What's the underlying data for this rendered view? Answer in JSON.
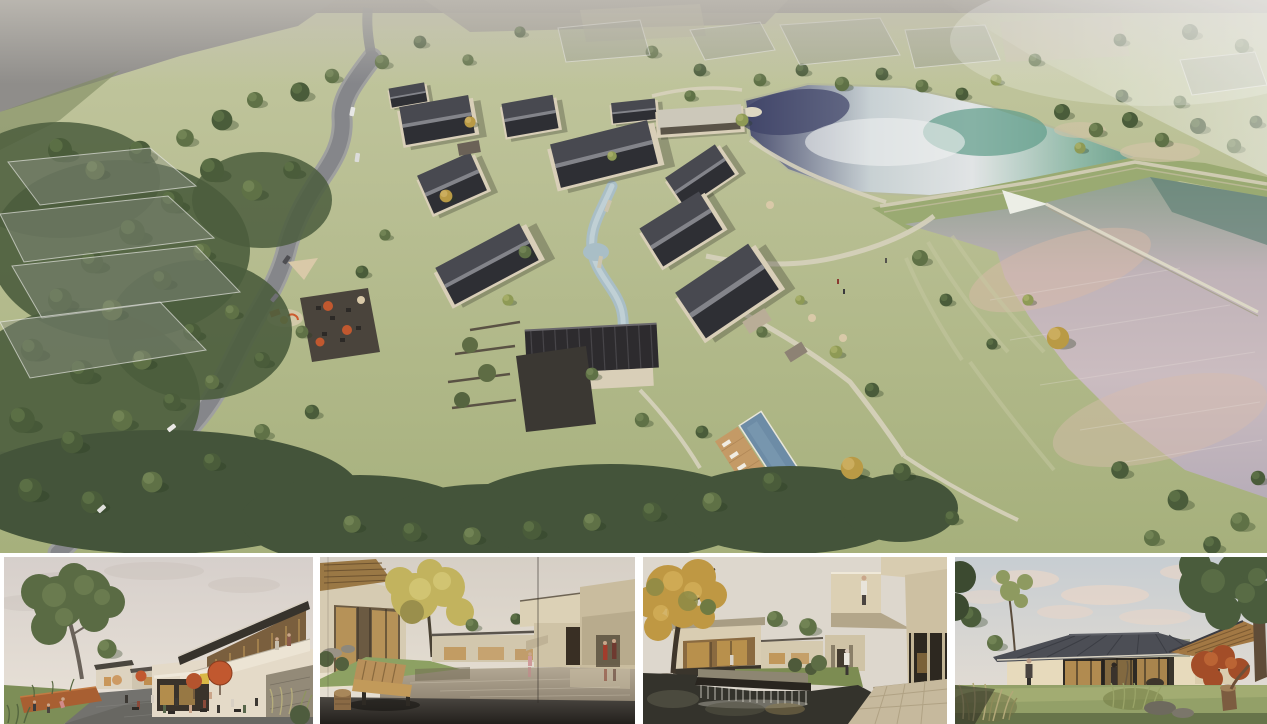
{
  "page": {
    "title": "architectural-rendering-board",
    "description": "Presentation board with one large aerial rendering and four eye-level renderings of a courtyard-house resort village"
  },
  "panels": {
    "main": {
      "name": "aerial-masterplan-render",
      "description": "Aerial view of a village resort: cluster of cream courtyard houses with dark gable roofs, winding grey road on the left through woodland, translucent future-phase volumes, a stream and swimming pool among the houses, a teal upper pond and a large rose-grey lower lake separated by a grass dam with a thin weir path"
    },
    "thumbnails": [
      {
        "name": "street-plaza-render",
        "description": "Evening village street with cafe terrace, orange umbrellas, people, lawn with corten planter and a two-storey timber-roofed building"
      },
      {
        "name": "courtyard-pond-render",
        "description": "Courtyard reflecting pond with wooden bench and carved stool in the foreground, yellow tree and cream guest houses, two figures in red at a passage"
      },
      {
        "name": "waterfall-court-render",
        "description": "Dark koi pond with stone weir waterfall, autumn tree at left, cantilevered cream balcony with a standing figure and stone-paved walk at right"
      },
      {
        "name": "garden-pavilion-render",
        "description": "Single-storey glass pavilion at dusk with broad dark hip roof, warm lit interior, red maple, meadow grasses, rocks and a tree stump"
      }
    ]
  },
  "palette": {
    "page_bg": "#ffffff",
    "grass": "#a6b07c",
    "grass_light": "#bcc492",
    "forest": "#4b5d3d",
    "road": "#85868a",
    "road_edge": "#9fa09f",
    "roof_dark": "#2e2f34",
    "roof_lit": "#484950",
    "wall": "#d9cfb8",
    "wood": "#a87c48",
    "water_pale": "#dfe2e5",
    "water_teal": "#6ba08e",
    "water_ink": "#3d4166",
    "water_rose": "#cbbcc0",
    "pool": "#6d8ca6",
    "deck": "#c49a66",
    "path": "#d7d2bd",
    "pavement": "#73726e",
    "umbrella": "#c1582f",
    "parasol": "#d9c9a8",
    "corten": "#a85f32",
    "sign": "#d9b845",
    "cream": "#e2d8c6",
    "overlay_glass": "#8f948a",
    "sky_warm": "#ded6cf",
    "sky_cool": "#ccd2d4",
    "cloud_pink": "#e8d5c8",
    "glass_warm": "#c49c5e"
  }
}
